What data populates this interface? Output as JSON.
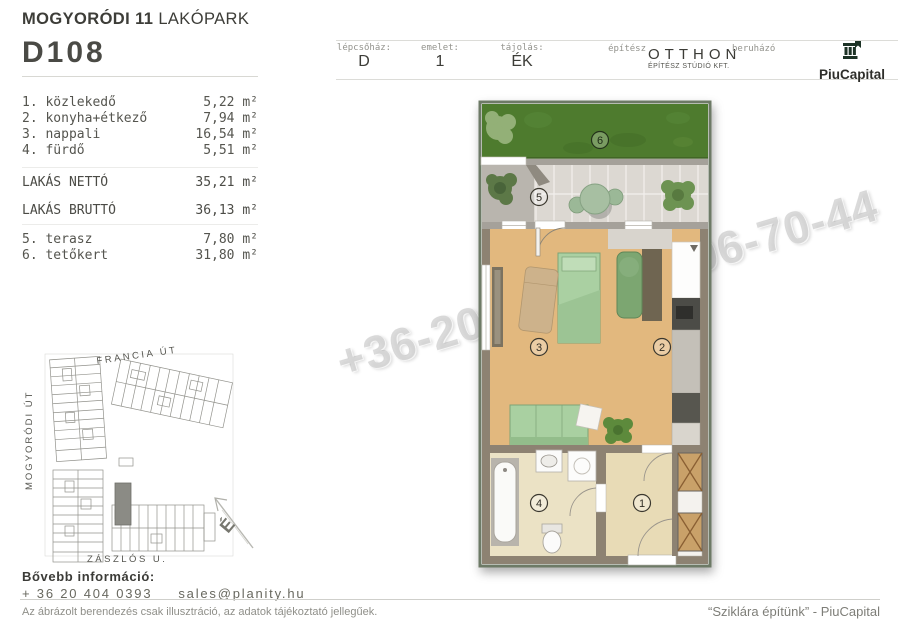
{
  "project": {
    "title_bold": "MOGYORÓDI 11",
    "title_regular": " LAKÓPARK",
    "unit_id": "D108"
  },
  "info_bar": {
    "cells": [
      {
        "label": "lépcsőház:",
        "value": "D"
      },
      {
        "label": "emelet:",
        "value": "1"
      },
      {
        "label": "tájolás:",
        "value": "ÉK"
      }
    ],
    "architect": {
      "label": "építész",
      "name": "OTTHON",
      "subtitle": "ÉPÍTÉSZ STÚDIÓ KFT."
    },
    "developer": {
      "label": "beruházó",
      "name": "PiuCapital",
      "logo_icon": "classical-column-icon"
    }
  },
  "rooms": [
    {
      "label": "1. közlekedő",
      "area": "5,22 m²"
    },
    {
      "label": "2. konyha+étkező",
      "area": "7,94 m²"
    },
    {
      "label": "3. nappali",
      "area": "16,54 m²"
    },
    {
      "label": "4. fürdő",
      "area": "5,51 m²"
    }
  ],
  "totals": [
    {
      "label": "LAKÁS NETTÓ",
      "area": "35,21 m²"
    },
    {
      "label": "LAKÁS BRUTTÓ",
      "area": "36,13 m²"
    }
  ],
  "outdoor": [
    {
      "label": "5. terasz",
      "area": "7,80 m²"
    },
    {
      "label": "6. tetőkert",
      "area": "31,80 m²"
    }
  ],
  "site_map": {
    "streets": {
      "top": "FRANCIA ÚT",
      "left": "MOGYORÓDI ÚT",
      "bottom": "ZÁSZLÓS U."
    },
    "north_label": "É"
  },
  "floor_plan": {
    "labels": {
      "hall": "1",
      "kitchen": "2",
      "living": "3",
      "bath": "4",
      "terrace": "5",
      "roof_garden": "6"
    }
  },
  "watermark": {
    "text": "+36-20-404-039906-70-44"
  },
  "contact": {
    "heading": "Bővebb információ:",
    "phone": "+ 36 20 404 0393",
    "email": "sales@planity.hu"
  },
  "footer": {
    "disclaimer": "Az ábrázolt berendezés csak illusztráció, az adatok tájékoztató jellegűek.",
    "slogan": "“Sziklára építünk” - PiuCapital"
  },
  "colors": {
    "logo_green": "#1d3326",
    "grass": "#4e7b2e",
    "wood_floor": "#e2b87e",
    "furniture_green": "#aad0a2",
    "bath_floor": "#ebe2c5",
    "wall": "#8d8272"
  }
}
